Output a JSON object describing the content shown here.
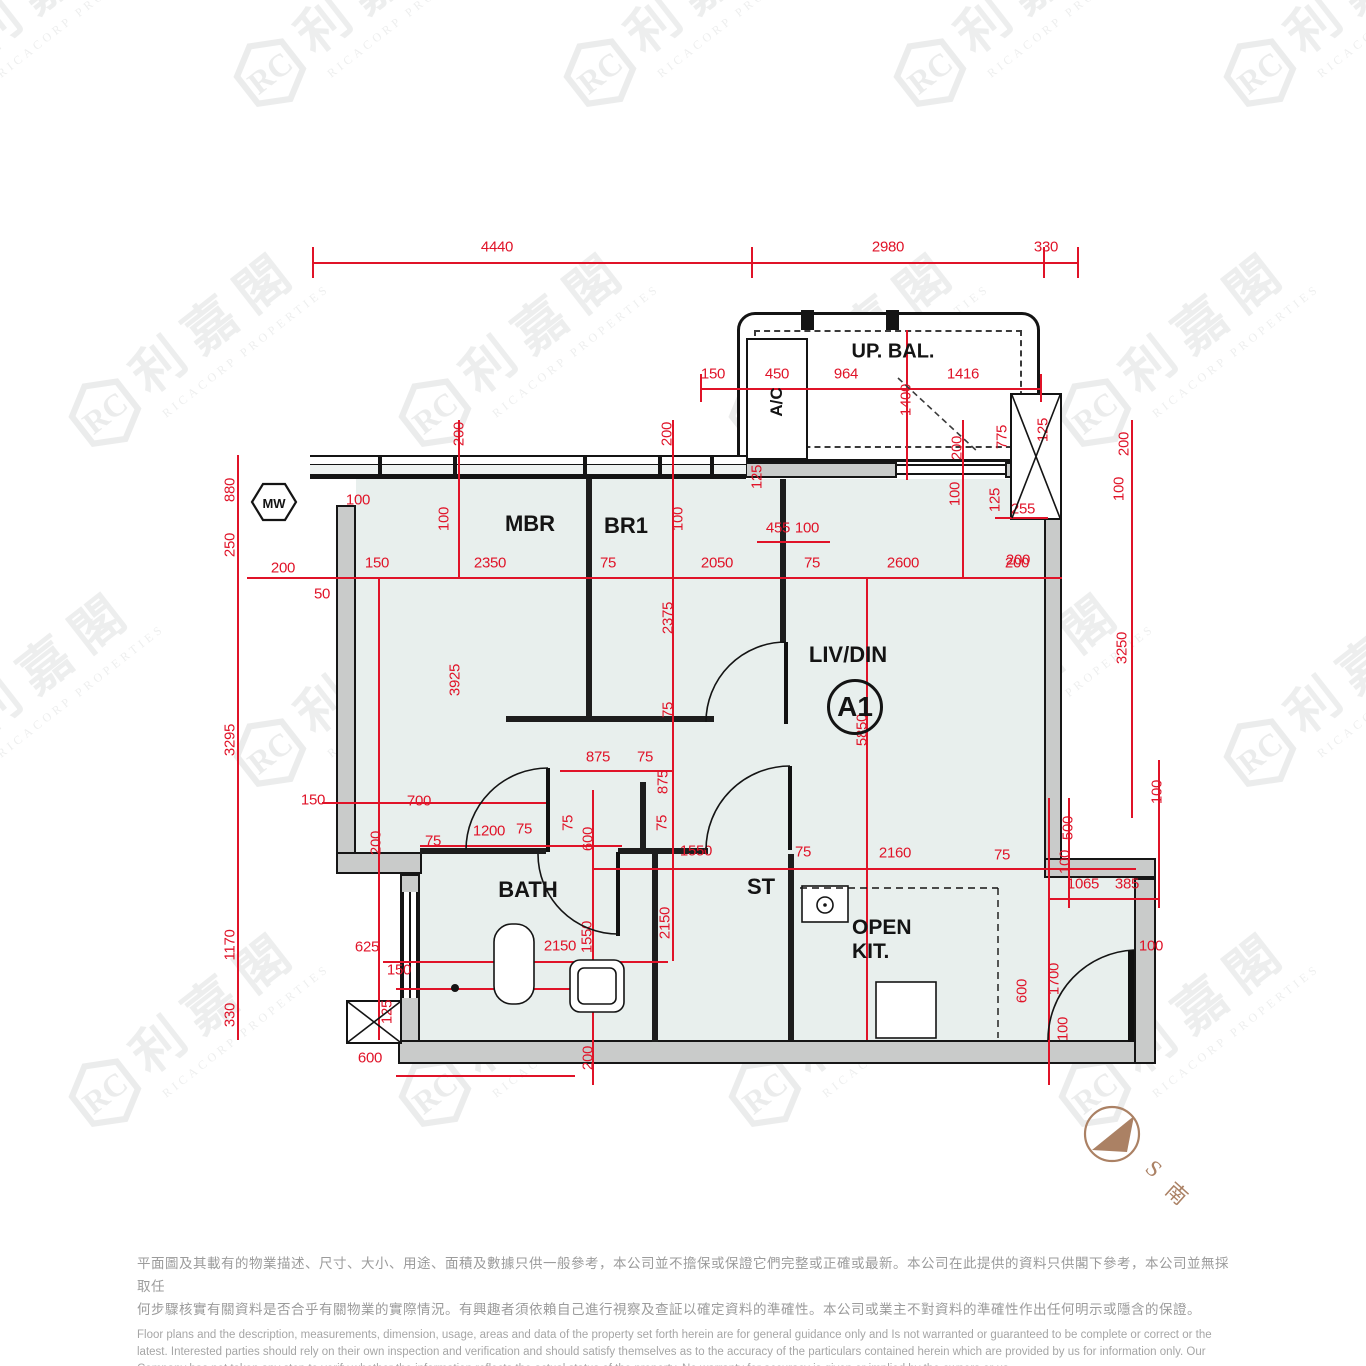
{
  "watermark": {
    "logo_text": "RC",
    "cn": "利嘉閣",
    "en": "RICACORP PROPERTIES"
  },
  "labels": {
    "mbr": "MBR",
    "br1": "BR1",
    "liv_din": "LIV/DIN",
    "unit": "A1",
    "bath": "BATH",
    "storage": "ST",
    "open_kit_1": "OPEN",
    "open_kit_2": "KIT.",
    "upper_balcony": "UP. BAL.",
    "ac": "A/C",
    "mw": "MW"
  },
  "compass": {
    "letter": "S",
    "cn": "南"
  },
  "colors": {
    "dimension_red": "#e01328",
    "room_fill": "#e8efed",
    "wall_dark": "#1d1d1d",
    "wall_core": "#c9cbca",
    "compass_brown": "#ab8164",
    "watermark_gray": "#e9e9e9",
    "disclaimer_gray": "#9b9b9b"
  },
  "disclaimer": {
    "zh": [
      "平面圖及其載有的物業描述、尺寸、大小、用途、面積及數據只供一般參考，本公司並不擔保或保證它們完整或正確或最新。本公司在此提供的資料只供閣下參考，本公司並無採取任",
      "何步驟核實有關資料是否合乎有關物業的實際情況。有興趣者須依賴自己進行視察及查証以確定資料的準確性。本公司或業主不對資料的準確性作出任何明示或隱含的保證。"
    ],
    "en": [
      "Floor plans and the description, measurements, dimension, usage, areas and data of the property set forth herein are for general guidance only and Is not warranted or guaranteed to be complete or correct or the",
      "latest. Interested parties should rely on their own inspection and verification and should satisfy themselves as to the accuracy of the particulars contained herein which are provided by us for information only.  Our",
      "Company has not taken any step to verify whether the information reflects the actual status of the property.  No warranty for accuracy is given or implied by the owners or us."
    ]
  },
  "dimensions": [
    {
      "t": "4440",
      "x": 497,
      "y": 247
    },
    {
      "t": "2980",
      "x": 888,
      "y": 247
    },
    {
      "t": "330",
      "x": 1046,
      "y": 247
    },
    {
      "t": "150",
      "x": 713,
      "y": 374
    },
    {
      "t": "450",
      "x": 777,
      "y": 374
    },
    {
      "t": "964",
      "x": 846,
      "y": 374
    },
    {
      "t": "1416",
      "x": 963,
      "y": 374
    },
    {
      "t": "1400",
      "x": 906,
      "y": 400,
      "v": 1
    },
    {
      "t": "775",
      "x": 1002,
      "y": 437,
      "v": 1
    },
    {
      "t": "125",
      "x": 1043,
      "y": 430,
      "v": 1
    },
    {
      "t": "200",
      "x": 1124,
      "y": 444,
      "v": 1
    },
    {
      "t": "100",
      "x": 1119,
      "y": 489,
      "v": 1
    },
    {
      "t": "3250",
      "x": 1122,
      "y": 648,
      "v": 1
    },
    {
      "t": "100",
      "x": 1157,
      "y": 792,
      "v": 1
    },
    {
      "t": "125",
      "x": 757,
      "y": 477,
      "v": 1
    },
    {
      "t": "455",
      "x": 778,
      "y": 528
    },
    {
      "t": "100",
      "x": 807,
      "y": 528
    },
    {
      "t": "100",
      "x": 955,
      "y": 494,
      "v": 1
    },
    {
      "t": "125",
      "x": 995,
      "y": 500,
      "v": 1
    },
    {
      "t": "255",
      "x": 1023,
      "y": 509
    },
    {
      "t": "200",
      "x": 1018,
      "y": 560
    },
    {
      "t": "200",
      "x": 459,
      "y": 434,
      "v": 1
    },
    {
      "t": "200",
      "x": 667,
      "y": 434,
      "v": 1
    },
    {
      "t": "200",
      "x": 957,
      "y": 448,
      "v": 1
    },
    {
      "t": "100",
      "x": 358,
      "y": 500
    },
    {
      "t": "100",
      "x": 444,
      "y": 519,
      "v": 1
    },
    {
      "t": "100",
      "x": 678,
      "y": 519,
      "v": 1
    },
    {
      "t": "200",
      "x": 283,
      "y": 568
    },
    {
      "t": "150",
      "x": 377,
      "y": 563
    },
    {
      "t": "2350",
      "x": 490,
      "y": 563
    },
    {
      "t": "75",
      "x": 608,
      "y": 563
    },
    {
      "t": "2050",
      "x": 717,
      "y": 563
    },
    {
      "t": "75",
      "x": 812,
      "y": 563
    },
    {
      "t": "2600",
      "x": 903,
      "y": 563
    },
    {
      "t": "200",
      "x": 1017,
      "y": 563
    },
    {
      "t": "50",
      "x": 322,
      "y": 594
    },
    {
      "t": "880",
      "x": 230,
      "y": 490,
      "v": 1
    },
    {
      "t": "250",
      "x": 230,
      "y": 545,
      "v": 1
    },
    {
      "t": "3295",
      "x": 230,
      "y": 740,
      "v": 1
    },
    {
      "t": "1170",
      "x": 230,
      "y": 945,
      "v": 1
    },
    {
      "t": "330",
      "x": 230,
      "y": 1015,
      "v": 1
    },
    {
      "t": "3925",
      "x": 455,
      "y": 680,
      "v": 1
    },
    {
      "t": "2375",
      "x": 668,
      "y": 618,
      "v": 1
    },
    {
      "t": "5850",
      "x": 862,
      "y": 730,
      "v": 1
    },
    {
      "t": "875",
      "x": 598,
      "y": 757
    },
    {
      "t": "75",
      "x": 645,
      "y": 757
    },
    {
      "t": "75",
      "x": 668,
      "y": 710,
      "v": 1
    },
    {
      "t": "875",
      "x": 663,
      "y": 782,
      "v": 1
    },
    {
      "t": "150",
      "x": 313,
      "y": 800
    },
    {
      "t": "700",
      "x": 419,
      "y": 801
    },
    {
      "t": "200",
      "x": 376,
      "y": 843,
      "v": 1
    },
    {
      "t": "75",
      "x": 433,
      "y": 841
    },
    {
      "t": "1200",
      "x": 489,
      "y": 831
    },
    {
      "t": "75",
      "x": 524,
      "y": 829
    },
    {
      "t": "75",
      "x": 568,
      "y": 823,
      "v": 1
    },
    {
      "t": "600",
      "x": 588,
      "y": 839,
      "v": 1
    },
    {
      "t": "75",
      "x": 662,
      "y": 823,
      "v": 1
    },
    {
      "t": "1550",
      "x": 696,
      "y": 851
    },
    {
      "t": "75",
      "x": 803,
      "y": 852
    },
    {
      "t": "2160",
      "x": 895,
      "y": 853
    },
    {
      "t": "75",
      "x": 1002,
      "y": 855
    },
    {
      "t": "500",
      "x": 1068,
      "y": 828,
      "v": 1
    },
    {
      "t": "100",
      "x": 1065,
      "y": 862,
      "v": 1
    },
    {
      "t": "1065",
      "x": 1083,
      "y": 884
    },
    {
      "t": "385",
      "x": 1127,
      "y": 884
    },
    {
      "t": "100",
      "x": 1151,
      "y": 946
    },
    {
      "t": "2150",
      "x": 560,
      "y": 946
    },
    {
      "t": "1550",
      "x": 587,
      "y": 937,
      "v": 1
    },
    {
      "t": "2150",
      "x": 665,
      "y": 923,
      "v": 1
    },
    {
      "t": "625",
      "x": 367,
      "y": 947
    },
    {
      "t": "150",
      "x": 399,
      "y": 970
    },
    {
      "t": "125",
      "x": 387,
      "y": 1012,
      "v": 1
    },
    {
      "t": "600",
      "x": 370,
      "y": 1058
    },
    {
      "t": "200",
      "x": 588,
      "y": 1058,
      "v": 1
    },
    {
      "t": "1700",
      "x": 1054,
      "y": 979,
      "v": 1
    },
    {
      "t": "600",
      "x": 1022,
      "y": 991,
      "v": 1
    },
    {
      "t": "100",
      "x": 1063,
      "y": 1029,
      "v": 1
    }
  ]
}
